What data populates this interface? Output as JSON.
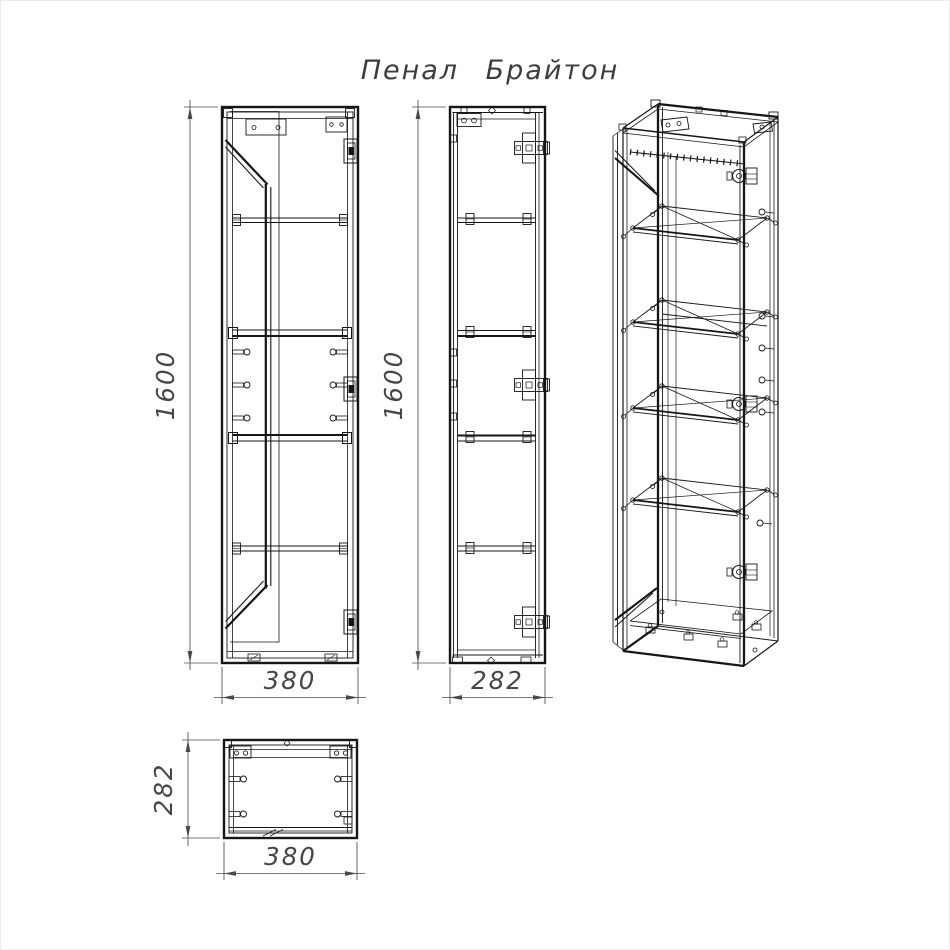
{
  "title": "Пенал Брайтон",
  "colors": {
    "line": "#161616",
    "dimension": "#4a4a4a",
    "background": "#ffffff"
  },
  "dimensions": {
    "front_view": {
      "height": "1600",
      "width": "380"
    },
    "side_view": {
      "height": "1600",
      "depth": "282"
    },
    "top_view": {
      "depth": "282",
      "width": "380"
    }
  }
}
